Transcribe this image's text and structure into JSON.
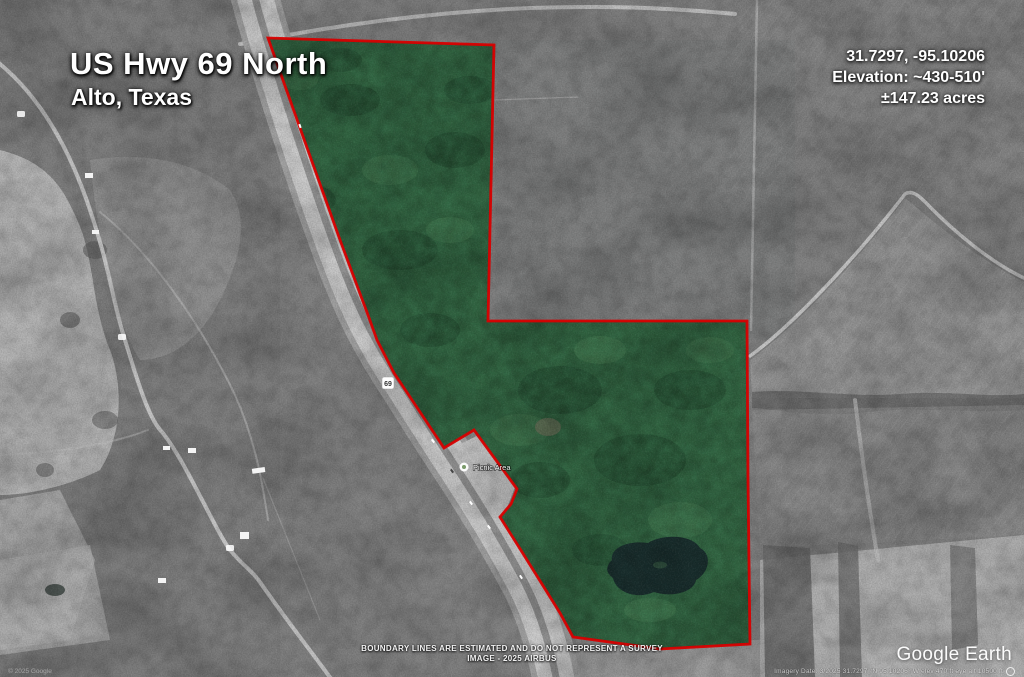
{
  "header": {
    "title": "US Hwy 69 North",
    "subtitle": "Alto, Texas"
  },
  "property_info": {
    "coordinates": "31.7297, -95.10206",
    "elevation": "Elevation: ~430-510'",
    "area": "±147.23 acres"
  },
  "map_labels": {
    "highway_shield": "69",
    "poi_label": "Picnic Area"
  },
  "footer": {
    "disclaimer_line1": "BOUNDARY LINES ARE ESTIMATED AND DO NOT REPRESENT A SURVEY",
    "disclaimer_line2": "IMAGE - 2025 AIRBUS",
    "watermark": "Google Earth",
    "status_bar": "Imagery Date: 3/2025    31.7297° N  95.10206° W    elev 470 ft    eye alt 10500 ft",
    "copyright": "© 2025 Google"
  },
  "colors": {
    "boundary": "#d80000",
    "property_fill": "#30603e",
    "pond": "#1a2f2e"
  }
}
